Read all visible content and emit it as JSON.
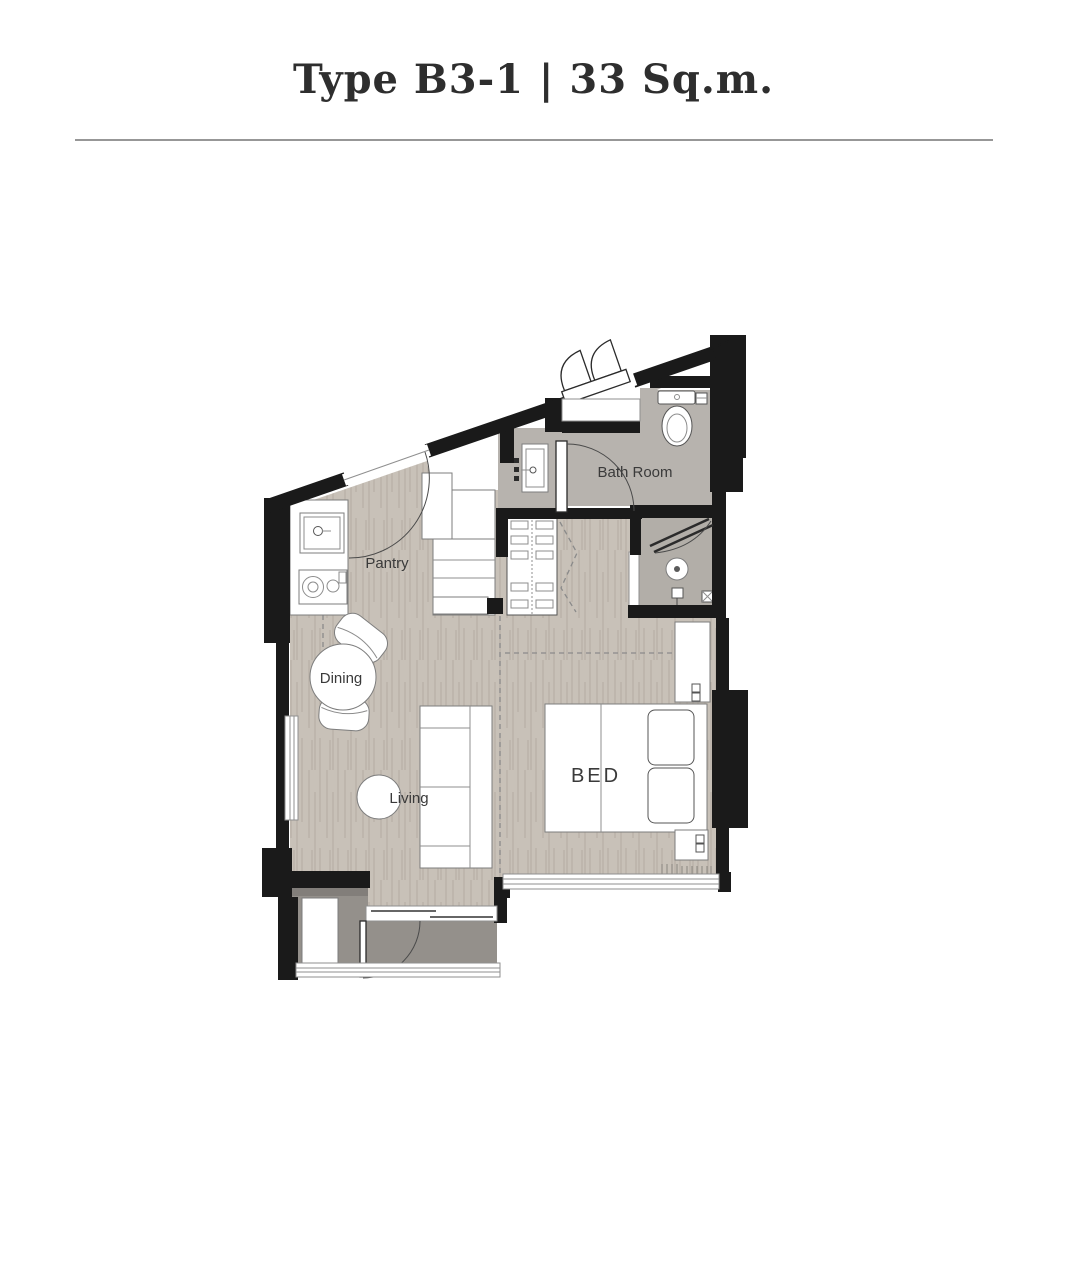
{
  "header": {
    "title": "Type B3-1 | 33 Sq.m."
  },
  "floorplan": {
    "rooms": {
      "pantry": {
        "label": "Pantry"
      },
      "dining": {
        "label": "Dining"
      },
      "living": {
        "label": "Living"
      },
      "bedroom": {
        "label": "BED"
      },
      "bathroom": {
        "label": "Bath Room"
      }
    },
    "fixtures": [
      "entrance-double-door",
      "kitchen-sink",
      "stove",
      "fridge-cabinet",
      "vanity-basin",
      "wardrobe",
      "toilet",
      "shower-drain",
      "shower-head",
      "dining-table",
      "dining-chairs",
      "coffee-table",
      "sofa",
      "tv-cabinet",
      "double-bed",
      "pillows",
      "nightstands",
      "balcony-unit",
      "sliding-door"
    ],
    "colors": {
      "wall": "#1a1a1a",
      "floor_wood": "#c8c1b8",
      "floor_wood_grain": "#b4ac a2",
      "floor_wet": "#b7b3ae",
      "floor_shower": "#b2aea8",
      "floor_balcony": "#94908b",
      "label": "#3a3a3a",
      "title": "#2e2e2e",
      "divider": "#979797"
    }
  }
}
